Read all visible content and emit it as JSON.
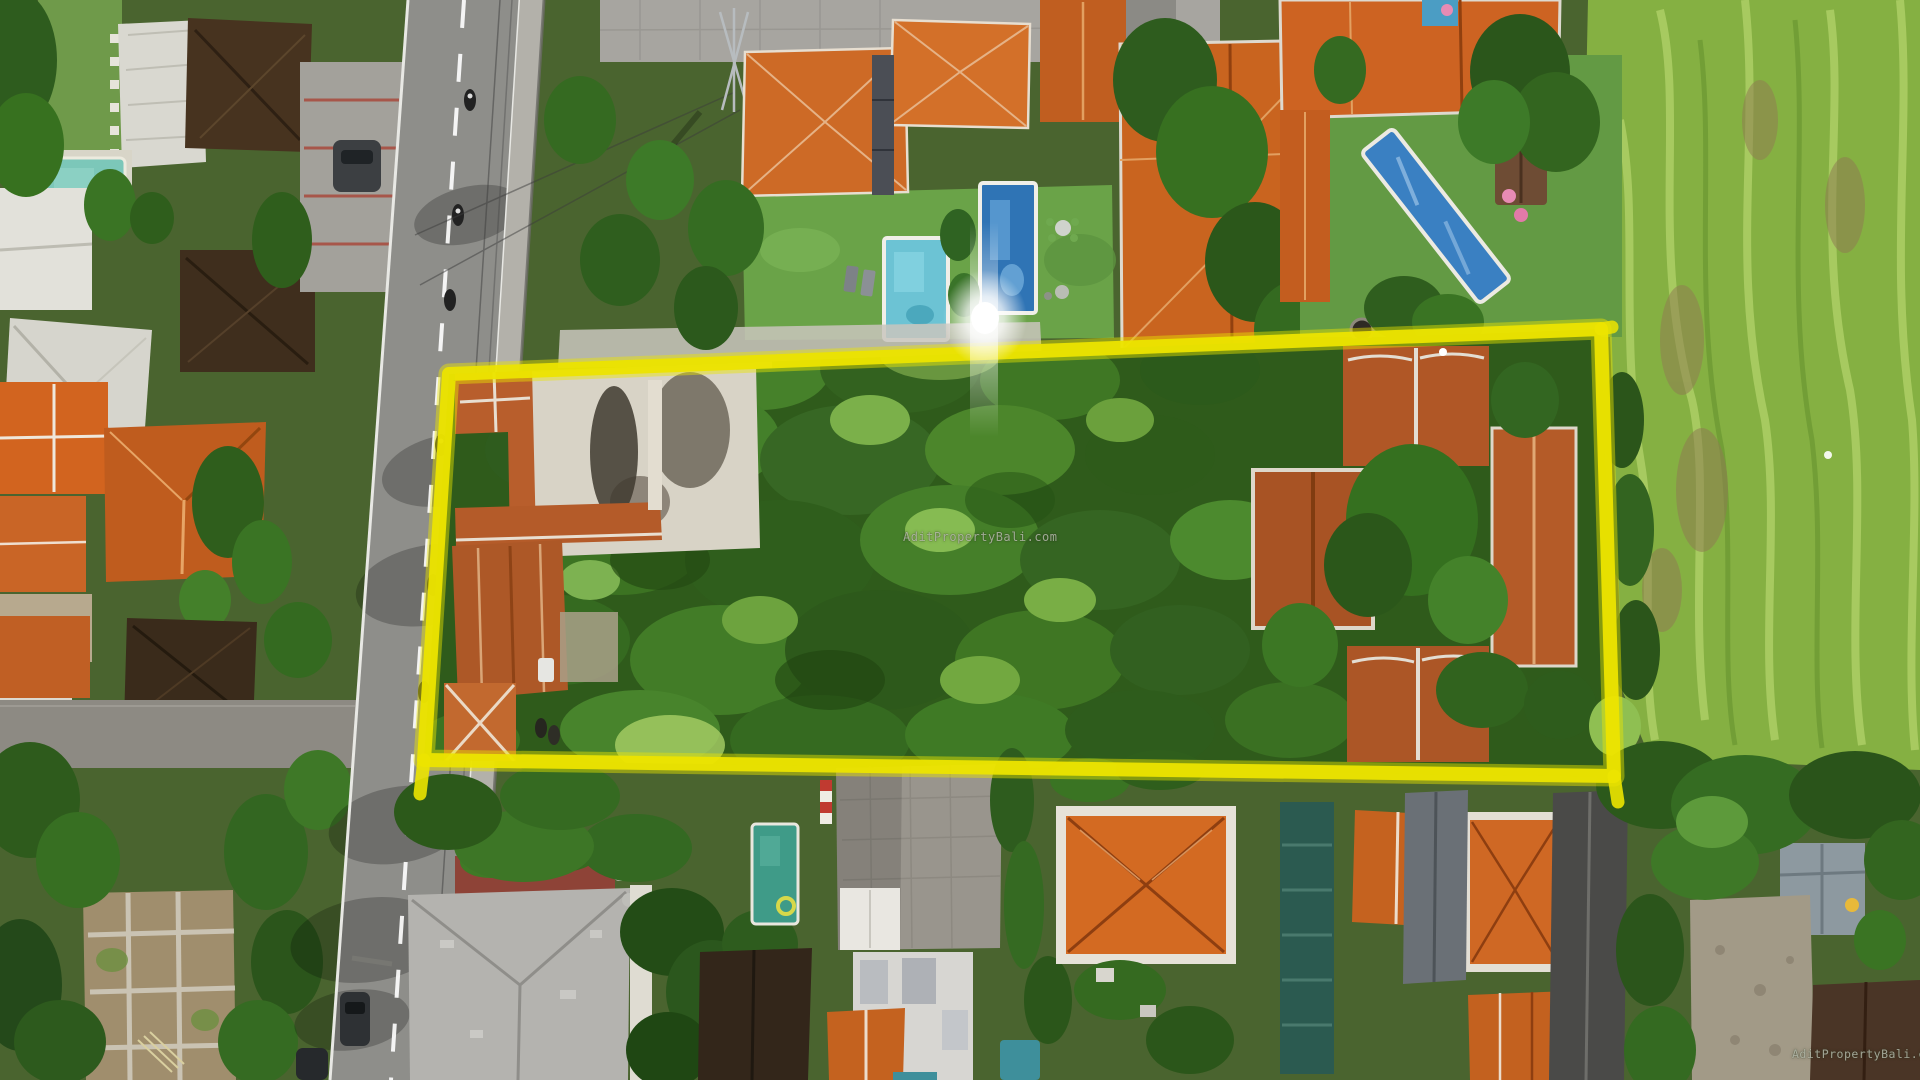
{
  "scene": {
    "type": "aerial-drone-photograph",
    "subject": "land plot for sale outlined in yellow among tropical villas, road on the left, rice field on the right",
    "boundary": {
      "label": "property-boundary",
      "shape": "rectangle-outline",
      "color": "#ece400"
    },
    "watermarks": {
      "center": "AditPropertyBali.com",
      "bottom_right": "AditPropertyBali.com"
    },
    "palette": {
      "canopy_green": "#2f5b1b",
      "rice_field_green": "#85b042",
      "roof_orange": "#c9661f",
      "roof_dark_brown": "#43311f",
      "road_gray": "#8e8e8a",
      "pool_blue": "#2f74b5",
      "pool_teal": "#7cc7b9",
      "pool_green": "#3f9b88"
    }
  }
}
